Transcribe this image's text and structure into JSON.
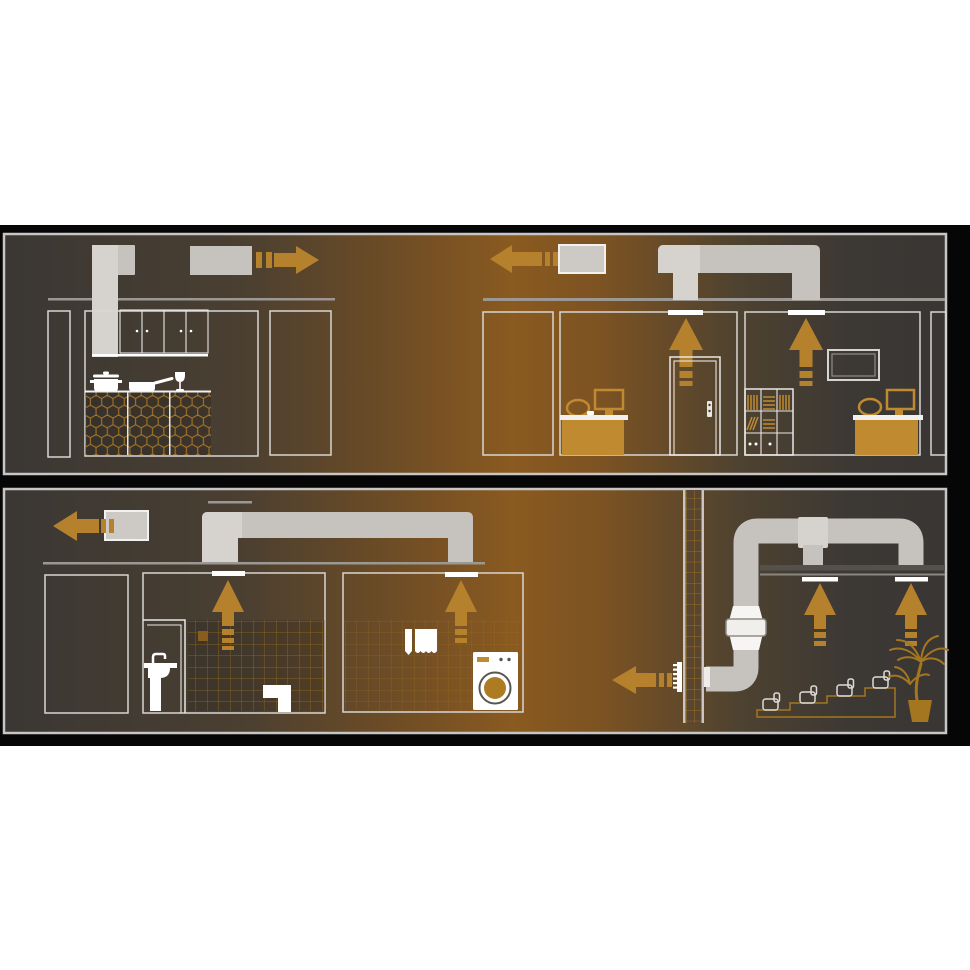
{
  "figure": {
    "type": "ventilation-system-diagram",
    "description": "Two-panel cutaway illustration of ducted exhaust ventilation"
  },
  "colors": {
    "panel-dark": "#3a3734",
    "panel-orange": "#8a5a20",
    "border": "#c8c6c4",
    "backdrop": "#060606",
    "duct": "#c6c2be",
    "duct-light": "#d6d3cf",
    "fanbox": "#cdc9c5",
    "fan-stroke": "#f2f1ef",
    "arrow": "#b5812d",
    "furn": "#c08a30",
    "tile": "#a4761f",
    "hex": "#b07b28",
    "line": "#d8d6d3",
    "line2": "#e9e7e5",
    "ceil": "#9b9894",
    "bar": "#54514d",
    "white": "#ffffff",
    "fanwhite": "#f6f5f3",
    "ring": "#5a554f",
    "accent-tile": "#8a5c1e",
    "chimney": "#5a4630"
  },
  "panels": [
    {
      "id": "top",
      "scenes": [
        {
          "name": "kitchen",
          "components": [
            "cooker-hood-duct",
            "exhaust-fan",
            "airflow-arrow-right",
            "ceiling-line",
            "wall-panel",
            "wall-cabinets",
            "hex-tile-counter",
            "pot",
            "pan",
            "wine-glass",
            "door-panel"
          ]
        },
        {
          "name": "offices",
          "components": [
            "exhaust-fan",
            "airflow-arrow-left",
            "duct-bridge",
            "ceiling-line",
            "ceiling-vent",
            "airflow-arrow-up",
            "door",
            "desk",
            "office-chair",
            "monitor",
            "bookcase",
            "wall-frame"
          ]
        }
      ]
    },
    {
      "id": "bottom",
      "scenes": [
        {
          "name": "bathroom-laundry",
          "components": [
            "exhaust-fan",
            "airflow-arrow-left",
            "duct-bridge",
            "ceiling-line",
            "ceiling-vent",
            "airflow-arrow-up",
            "bathroom-door",
            "sink",
            "toilet",
            "tiled-wall",
            "towels",
            "washing-machine"
          ]
        },
        {
          "name": "auditorium",
          "components": [
            "chimney-shaft",
            "wall-grille",
            "airflow-arrow-left",
            "round-duct",
            "inline-duct-fan",
            "t-junction",
            "suspended-ceiling",
            "ceiling-vent",
            "airflow-arrow-up",
            "tiered-seating",
            "palm-plant"
          ]
        }
      ]
    }
  ]
}
